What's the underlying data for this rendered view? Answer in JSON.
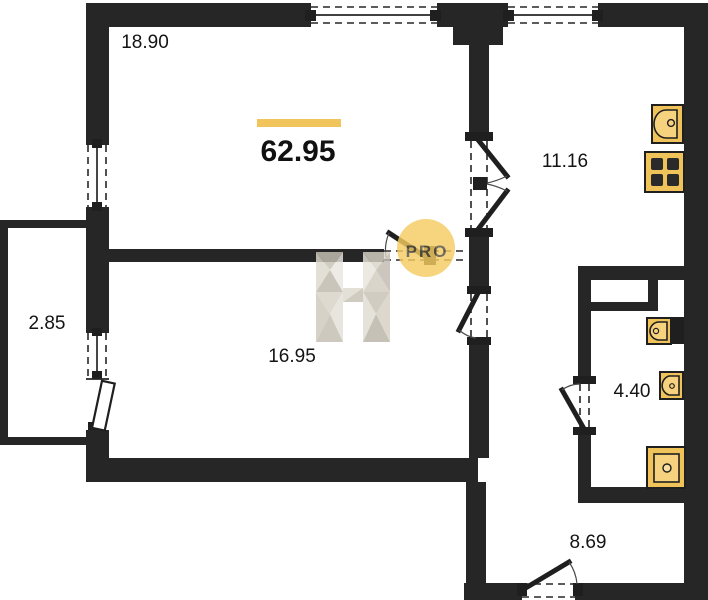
{
  "plan": {
    "total_area": "62.95",
    "rooms": [
      {
        "name": "living-room",
        "area": "18.90"
      },
      {
        "name": "bedroom",
        "area": "16.95"
      },
      {
        "name": "kitchen",
        "area": "11.16"
      },
      {
        "name": "bathroom",
        "area": "4.40"
      },
      {
        "name": "hallway",
        "area": "8.69"
      },
      {
        "name": "balcony",
        "area": "2.85"
      }
    ],
    "watermark": {
      "letter": "H",
      "badge": "PRO"
    },
    "icons": [
      "kitchen-sink-icon",
      "stove-icon",
      "toilet-icon",
      "washbasin-icon",
      "shower-icon"
    ],
    "colors": {
      "wall": "#262626",
      "accent_bar": "#F2C45C",
      "fixture_fill": "#EFC25A",
      "fixture_inner": "#F6D27E",
      "watermark_circle": "#F5CD62",
      "watermark_letter_light": "#e8e5de",
      "watermark_letter_dark": "#c0bab0"
    }
  }
}
